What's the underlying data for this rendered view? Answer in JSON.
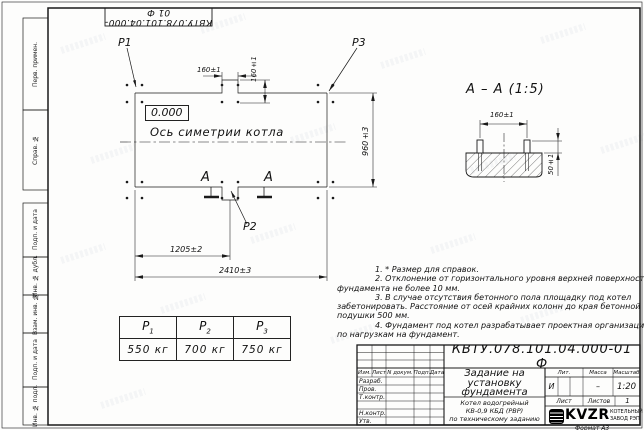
{
  "sheet": {
    "doc_number": "КВТУ.078.101.04.000-01 Ф",
    "format_label": "Формат А3"
  },
  "frame_strip": {
    "perv_primen": "Перв. примен.",
    "sprav_no": "Справ. №",
    "podp_data_1": "Подп. и дата",
    "inv_dubl": "Инв. № дубл.",
    "vzam_inv": "Взам. инв. №",
    "podp_data_2": "Подп. и дата",
    "inv_podl": "Инв. № подл."
  },
  "plan": {
    "labels": {
      "p1": "P1",
      "p2": "P2",
      "p3": "P3",
      "elevation": "0.000",
      "axis": "Ось симетрии котла",
      "section_letter": "А"
    },
    "dims": {
      "step_h": "160±1",
      "step_v": "160±1",
      "half_width": "1205±2",
      "total_width": "2410±3",
      "depth": "960±3"
    }
  },
  "section": {
    "title": "А – А (1:5)",
    "dims": {
      "bolt_spacing": "160±1",
      "bolt_height": "50±1"
    }
  },
  "notes": {
    "lines": [
      "1. * Размер для справок.",
      "2. Отклонение от горизонтального уровня верхней поверхности",
      "фундамента не более 10 мм.",
      "3. В случае отсутствия бетонного пола площадку под котел",
      "забетонировать. Расстояние от осей крайних колонн до края бетонной",
      "подушки 500 мм.",
      "4. Фундамент под котел разрабатывает проектная организация",
      "по нагрузкам на фундамент."
    ]
  },
  "loads_table": {
    "columns": [
      {
        "name": "P",
        "sub": "1",
        "value": "550 кг"
      },
      {
        "name": "P",
        "sub": "2",
        "value": "700 кг"
      },
      {
        "name": "P",
        "sub": "3",
        "value": "750 кг"
      }
    ]
  },
  "title_block": {
    "doc_number": "КВТУ.078.101.04.000-01 Ф",
    "title_lines": [
      "Задание на",
      "установку",
      "фундамента"
    ],
    "product_lines": [
      "Котел водогрейный",
      "КВ-0,9 КБД (РВР)",
      "по техническому заданию"
    ],
    "header_cols": {
      "izm": "Изм.",
      "list": "Лист",
      "doc": "N докум.",
      "podp": "Подп.",
      "data": "Дата"
    },
    "rows": [
      "Разраб.",
      "Пров.",
      "Т.контр.",
      "",
      "Н.контр.",
      "Утв."
    ],
    "lit_label": "Лит.",
    "massa_label": "Масса",
    "masshtab_label": "Масштаб",
    "lit_value": "И",
    "massa_value": "–",
    "masshtab_value": "1:20",
    "list_label": "Лист",
    "listov_label": "Листов",
    "listov_value": "1",
    "logo_text": "KVZR",
    "logo_sub1": "КОТЕЛЬНЫЙ",
    "logo_sub2": "ЗАВОД РЭП"
  }
}
